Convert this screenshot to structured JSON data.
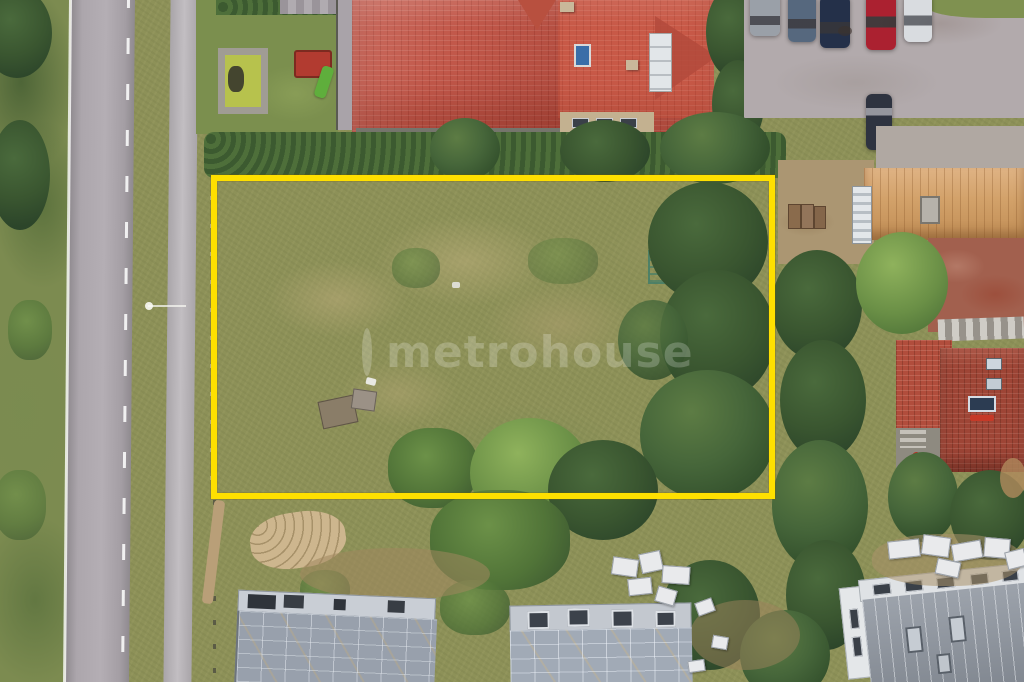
{
  "meta": {
    "title": "Aerial drone photo of a vacant land plot marked for sale",
    "image_width_px": 1024,
    "image_height_px": 682
  },
  "watermark": {
    "logo": "ring-logo",
    "text": "metrohouse",
    "color": "#ffffff",
    "opacity": 0.22
  },
  "plot_outline": {
    "shape": "rectangle",
    "color": "#fee000",
    "thickness_px": 6,
    "x": 211,
    "y": 175,
    "width": 564,
    "height": 324
  },
  "palette": {
    "meadow": "#8d9158",
    "dry_grass": "#b3a678",
    "road_asphalt": "#aca6ac",
    "sidewalk": "#b8b4b8",
    "red_tile_roof": "#c2584a",
    "orange_metal_roof": "#d2a169",
    "brick_tile_roof": "#9e4536",
    "tree_dark": "#3a5630",
    "tree_light": "#6a8f46",
    "gravel_parking": "#b2aaac",
    "construction_roof": "#98a0ac",
    "standing_seam_roof": "#8f96a0",
    "sand_patch": "#cbb48c",
    "car_colors": [
      "#9aa0a8",
      "#56687e",
      "#243049",
      "#ab2130",
      "#d9dce0",
      "#2e3340"
    ]
  },
  "scene_objects": [
    "asphalt-road",
    "sidewalk-path",
    "roadside-grass",
    "garden-pond-with-stone-frame",
    "playground-playhouse",
    "playground-slide",
    "large-red-roof-house",
    "roof-skylight",
    "roof-solar-panels",
    "gravel-parking-lot",
    "parked-cars",
    "vacant-grass-plot",
    "yellow-plot-boundary",
    "hedge-row",
    "tree-cluster",
    "orange-roof-house",
    "brick-roof-house",
    "paved-yard",
    "construction-building-left",
    "construction-building-middle",
    "modern-metal-roof-building",
    "building-material-stacks",
    "sand-patch",
    "dirt-path",
    "watermark"
  ]
}
